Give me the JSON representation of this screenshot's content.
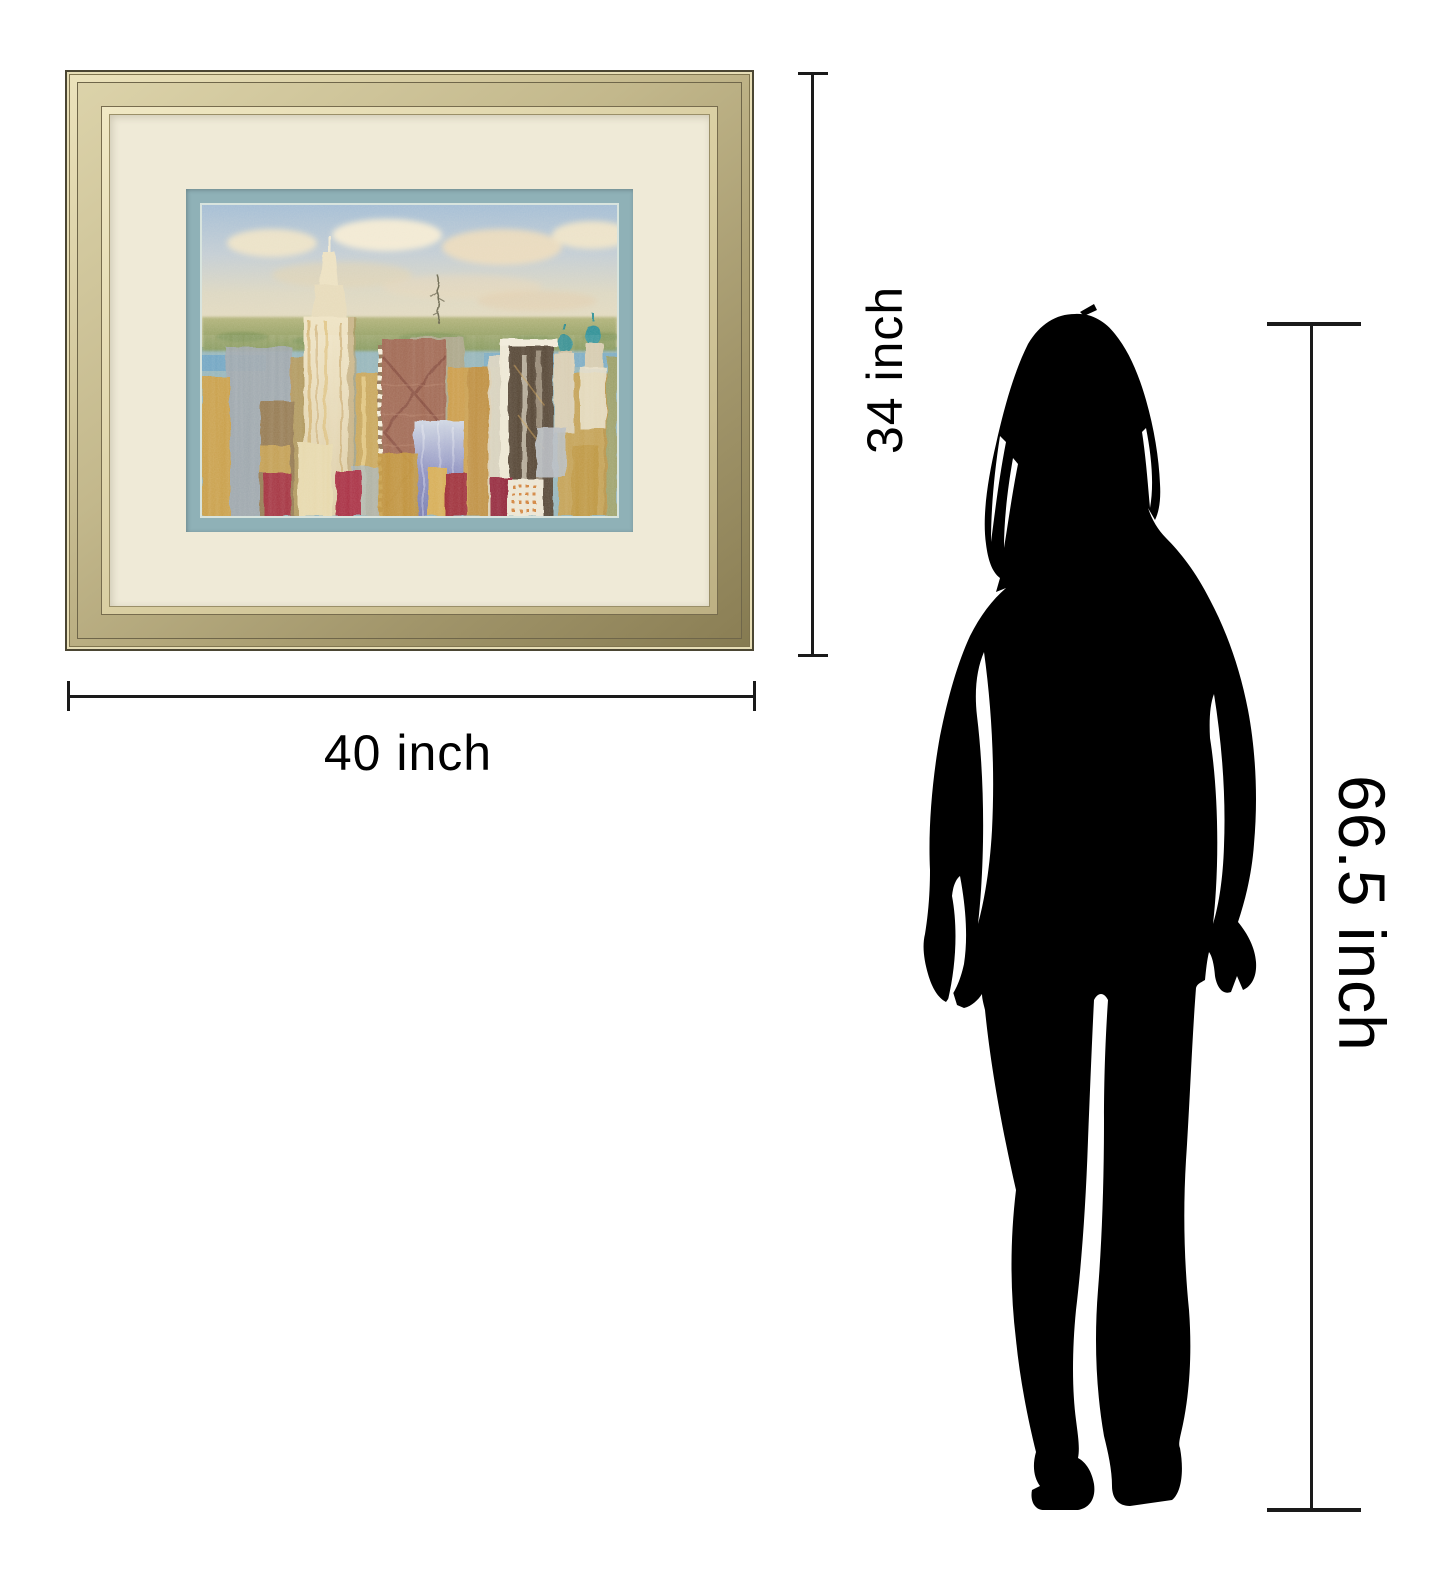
{
  "canvas": {
    "background": "#ffffff"
  },
  "artwork": {
    "kind": "framed city skyline print",
    "painting_subject": "abstract New York cityscape"
  },
  "dimensions": {
    "frame_height_label": "34 inch",
    "frame_width_label": "40 inch",
    "person_height_label": "66.5 inch"
  },
  "figure": {
    "kind": "standing woman silhouette"
  },
  "colors": {
    "dimension_line": "#1a1a1a",
    "text": "#000000",
    "frame_gold_light": "#ece3bc",
    "frame_gold_dark": "#857a51",
    "mat_cream": "#efead7",
    "mat_blue": "#8fb1b7",
    "silhouette": "#000000"
  }
}
